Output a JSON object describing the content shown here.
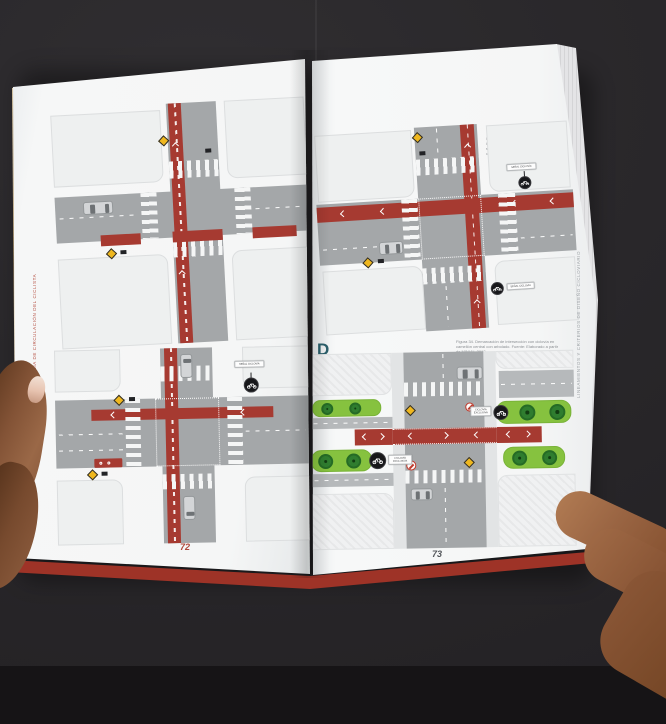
{
  "book": {
    "left_page": {
      "label": "B",
      "caption": "Figura 32. Demarcación de cruce en intersección con ciclovía unidireccional. Fuente: Elaborado a partir de SEDEMA, 2011.",
      "page_number": "72",
      "margin_text": "MEDIDAS PREVENTIVAS Y GUÍA DE CIRCULACIÓN DEL CICLISTA",
      "sign_label_b2": "SEÑAL CICLOVÍA"
    },
    "right_page": {
      "label_c": "C",
      "caption_c": "Figura 33. Demarcación de intersección con ciclovía a doble sentido. Fuente: Elaborado a partir de SEDEMA, 2011.",
      "label_d": "D",
      "caption_d": "Figura 34. Demarcación de intersección con ciclovía en camellón central con arbolado. Fuente: Elaborado a partir de MINVU, 2012.",
      "page_number": "73",
      "margin_text": "LINEAMIENTOS Y CRITERIOS DE DISEÑO CICLOVIARIO",
      "sign_label_c_top": "SEÑAL CICLOVÍA",
      "sign_label_c_bottom": "SEÑAL CICLOVÍA",
      "sign_label_d_left": "CICLOVÍA EXCLUSIVA",
      "sign_label_d_right": "CICLOVÍA EXCLUSIVA"
    },
    "colors": {
      "accent_red": "#a63a31",
      "cover_red": "#9e3327",
      "section_label_teal": "#2b5f6b",
      "green_median": "#86c23f",
      "page": "#f5f6f6",
      "background": "#2a282b"
    }
  }
}
